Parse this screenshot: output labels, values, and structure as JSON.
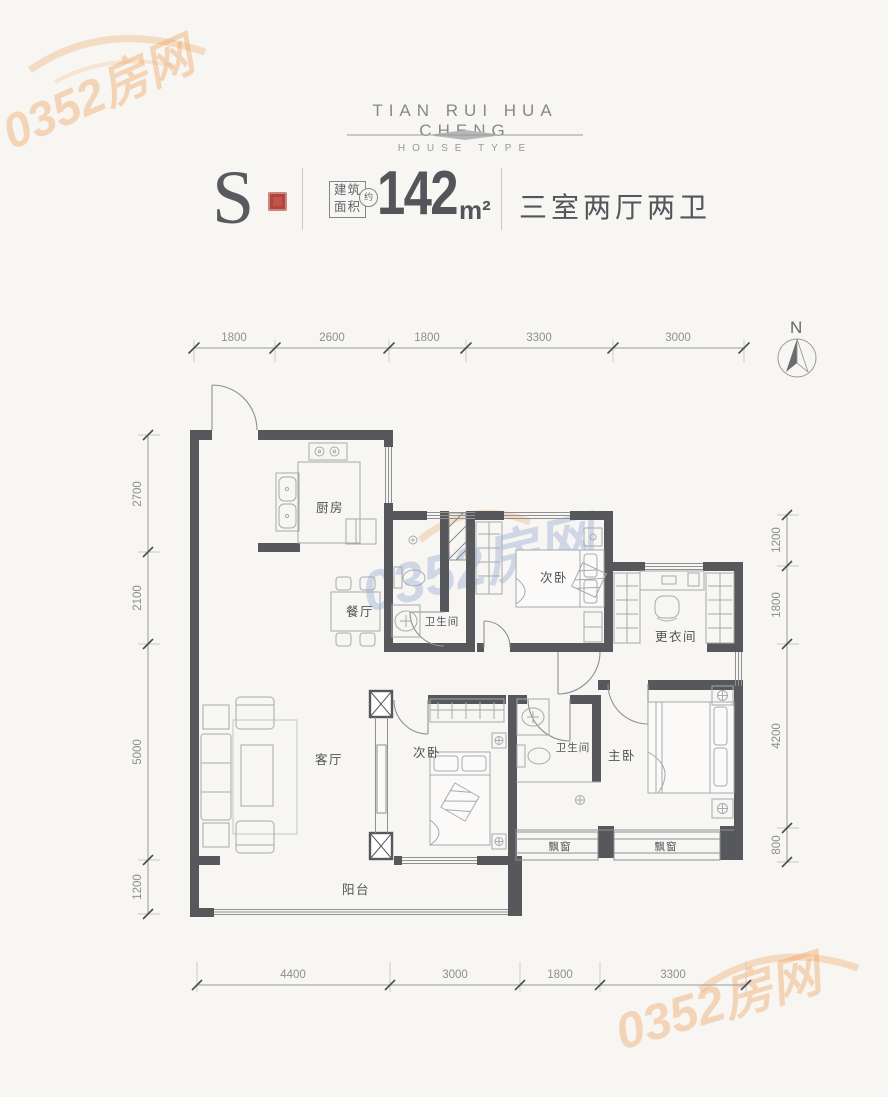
{
  "header": {
    "brand": "TIAN RUI HUA CHENG",
    "subtitle": "HOUSE TYPE"
  },
  "unit_info": {
    "type_letter": "S",
    "area_label_line1": "建筑",
    "area_label_line2": "面积",
    "approx": "约",
    "area_value": "142",
    "area_unit": "m²",
    "layout_text": "三室两厅两卫"
  },
  "compass": {
    "north_label": "N"
  },
  "dimensions": {
    "top": [
      "1800",
      "2600",
      "1800",
      "3300",
      "3000"
    ],
    "left": [
      "2700",
      "2100",
      "5000",
      "1200"
    ],
    "right": [
      "1200",
      "1800",
      "4200",
      "800"
    ],
    "bottom": [
      "4400",
      "3000",
      "1800",
      "3300"
    ]
  },
  "rooms": {
    "kitchen": "厨房",
    "dining": "餐厅",
    "bath1": "卫生间",
    "bedroom2_top": "次卧",
    "dressing": "更衣间",
    "living": "客厅",
    "bedroom2_bottom": "次卧",
    "bath2": "卫生间",
    "master": "主卧",
    "bay_left": "飘窗",
    "bay_right": "飘窗",
    "balcony": "阳台"
  },
  "watermark": {
    "text": "0352房网"
  },
  "colors": {
    "wall": "#57585b",
    "seal_red": "#c0544b",
    "watermark_orange": "#f0a35c",
    "watermark_blue": "#8ea4d2"
  }
}
